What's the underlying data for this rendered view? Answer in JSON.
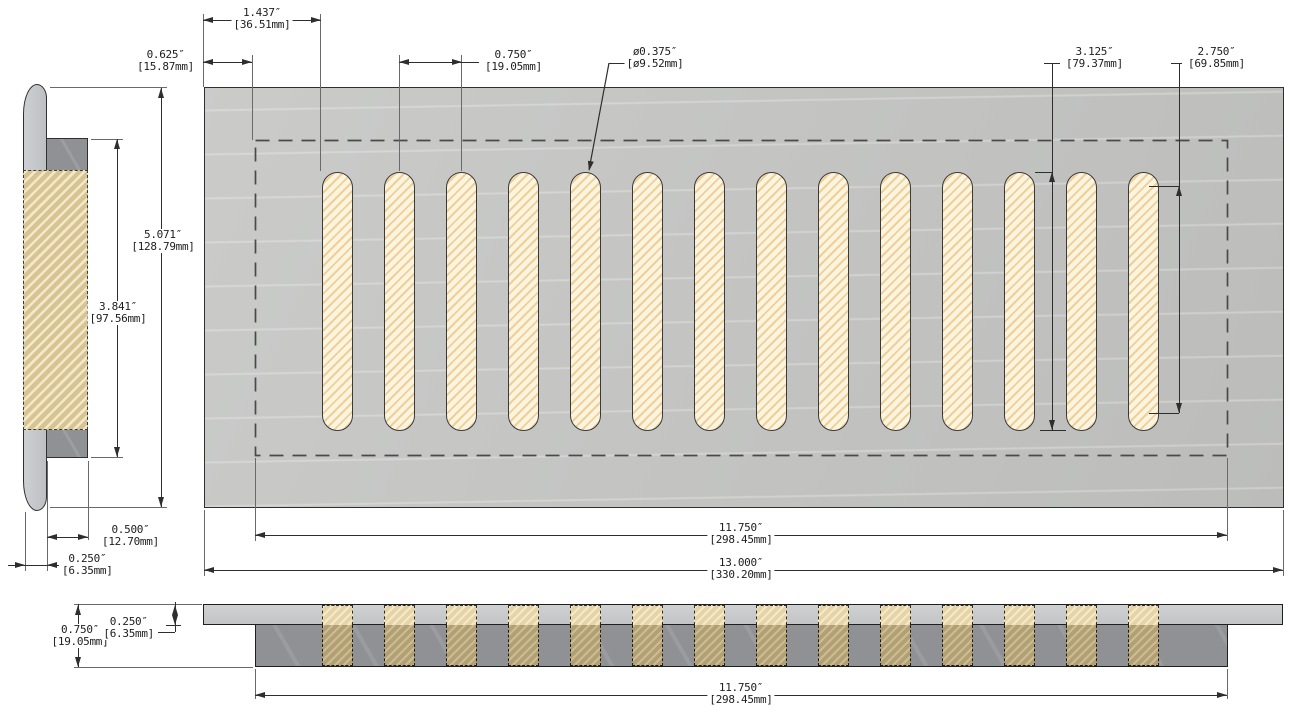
{
  "part": {
    "slot_count": 14
  },
  "dims": {
    "edge_to_first_slot": {
      "in": "1.437″",
      "mm": "[36.51mm]"
    },
    "edge_to_opening": {
      "in": "0.625″",
      "mm": "[15.87mm]"
    },
    "slot_pitch": {
      "in": "0.750″",
      "mm": "[19.05mm]"
    },
    "slot_diameter": {
      "in": "ø0.375″",
      "mm": "[ø9.52mm]"
    },
    "slot_length": {
      "in": "3.125″",
      "mm": "[79.37mm]"
    },
    "slot_straight_length": {
      "in": "2.750″",
      "mm": "[69.85mm]"
    },
    "overall_height": {
      "in": "5.071″",
      "mm": "[128.79mm]"
    },
    "opening_height": {
      "in": "3.841″",
      "mm": "[97.56mm]"
    },
    "duct_depth": {
      "in": "0.500″",
      "mm": "[12.70mm]"
    },
    "flange_thickness_side": {
      "in": "0.250″",
      "mm": "[6.35mm]"
    },
    "opening_width": {
      "in": "11.750″",
      "mm": "[298.45mm]"
    },
    "overall_width": {
      "in": "13.000″",
      "mm": "[330.20mm]"
    },
    "front_height": {
      "in": "0.750″",
      "mm": "[19.05mm]"
    },
    "front_plate_thickness": {
      "in": "0.250″",
      "mm": "[6.35mm]"
    },
    "front_opening_width": {
      "in": "11.750″",
      "mm": "[298.45mm]"
    }
  },
  "colors": {
    "plate_gray": "#c6c7c5",
    "flange_light_gray": "#c9cbcd",
    "duct_dark_gray": "#8f9194",
    "slot_fill": "#fbf4de",
    "slot_hatch": "#e7b05e",
    "section_fill": "#d8c493",
    "band_lower": "#b0a077",
    "line": "#2e2e2e",
    "dashed_outline": "#4a4a4a"
  }
}
